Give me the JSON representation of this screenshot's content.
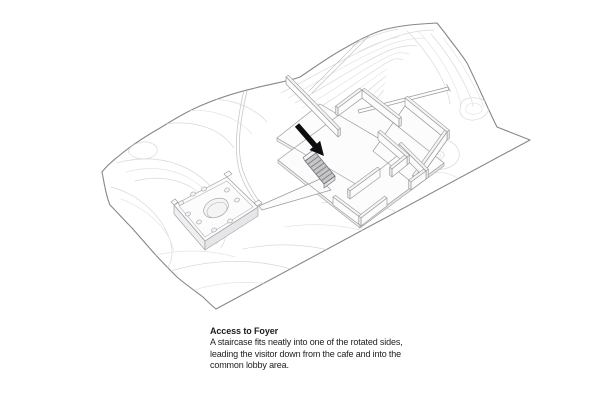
{
  "caption": {
    "title": "Access to Foyer",
    "body_lines": [
      "A staircase fits neatly into one of the rotated sides,",
      "leading the visitor down from the cafe and into the",
      "common lobby area."
    ]
  },
  "diagram": {
    "description": "Axonometric architectural site diagram: wavy-edged topographic site with contour lines, a courtyard building composed of rotated square slabs and freestanding walls, a hatched staircase marked by a black arrow, a tapering ramp, long thin paths, and a small pavilion with a perforated roof",
    "icons": {
      "arrow": "access-arrow-icon",
      "staircase": "hatched-stair"
    },
    "colors": {
      "bg": "#ffffff",
      "site_outline": "#85888b",
      "contour": "#d7d9da",
      "contour_light": "#e3e5e6",
      "trail": "#c6c8ca",
      "building_stroke": "#9a9b9d",
      "building_stroke_light": "#b4b5b7",
      "building_fill": "#fcfcfd",
      "shade": "#e6e6e8",
      "shade_mid": "#efeff1",
      "shade_light": "#f4f4f5",
      "arrow": "#0e0e10",
      "stair_fill": "#c6c6c8",
      "stair_tread": "#7f7f81",
      "stair_outline": "#6e6e70",
      "text": "#1d1d1f"
    }
  }
}
